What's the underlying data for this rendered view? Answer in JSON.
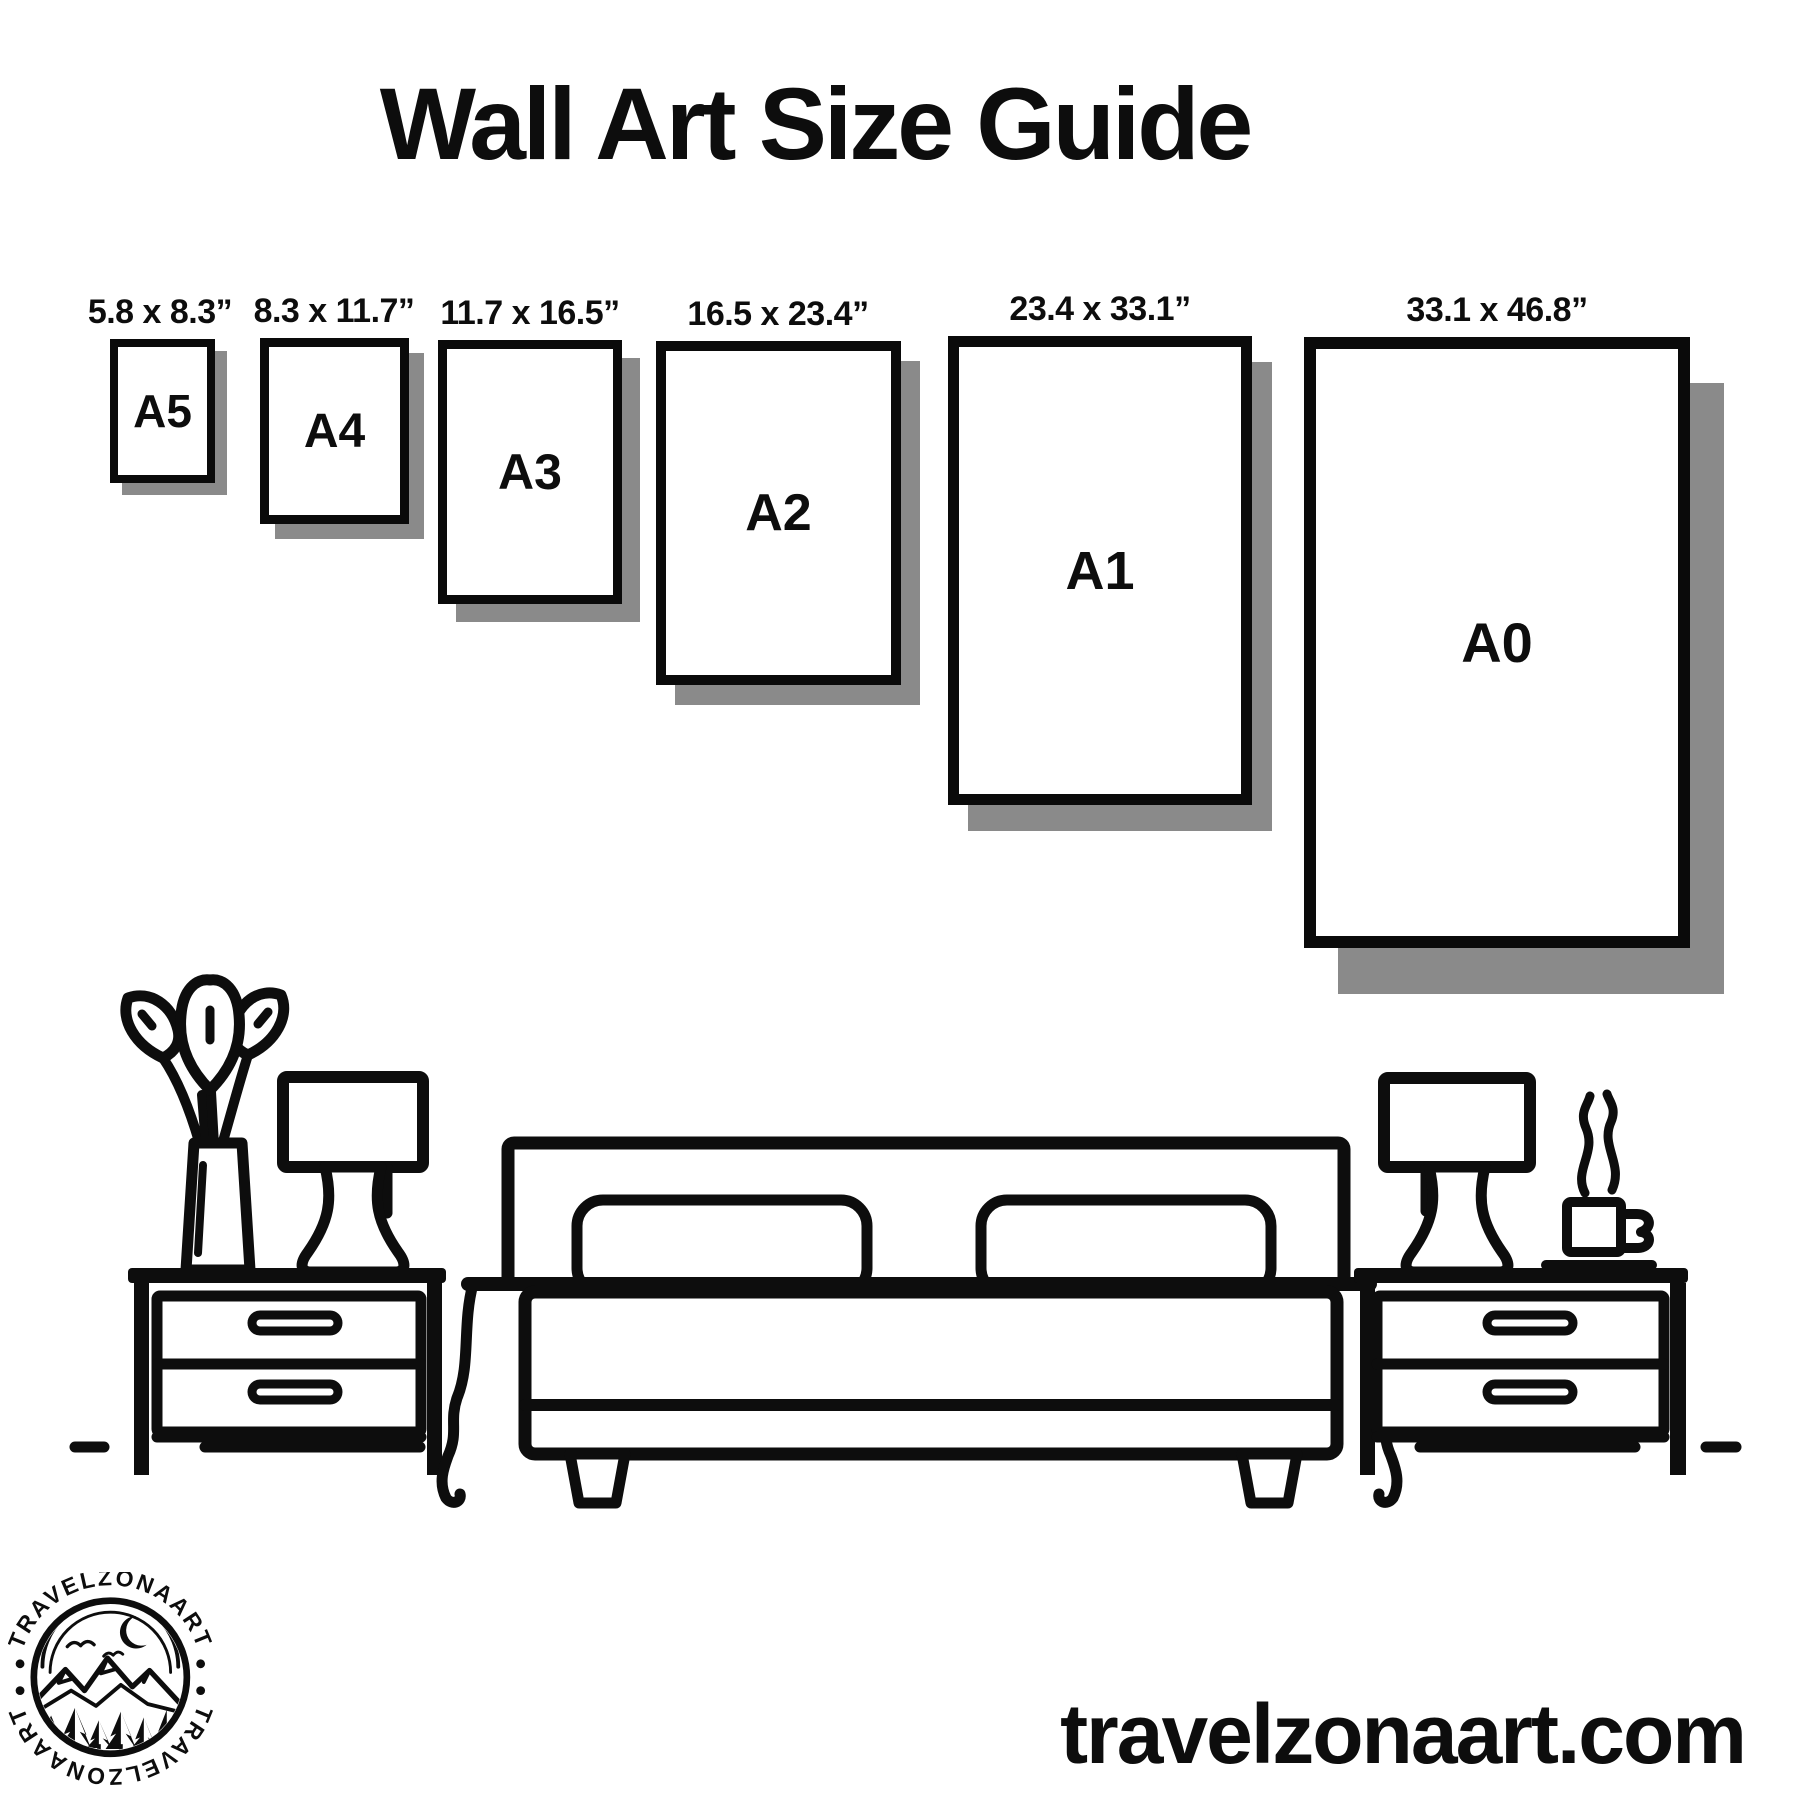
{
  "title": "Wall Art Size Guide",
  "sizes": [
    {
      "label": "A5",
      "dimensions": "5.8 x 8.3”"
    },
    {
      "label": "A4",
      "dimensions": "8.3 x 11.7”"
    },
    {
      "label": "A3",
      "dimensions": "11.7 x 16.5”"
    },
    {
      "label": "A2",
      "dimensions": "16.5 x 23.4”"
    },
    {
      "label": "A1",
      "dimensions": "23.4 x 33.1”"
    },
    {
      "label": "A0",
      "dimensions": "33.1 x 46.8”"
    }
  ],
  "logo": {
    "brand": "TRAVELZONAART"
  },
  "footer": {
    "website": "travelzonaart.com"
  },
  "colors": {
    "ink": "#0d0d0d",
    "frame_border": "#0a0a0a",
    "shadow": "#8a8a8a",
    "background": "#ffffff"
  }
}
